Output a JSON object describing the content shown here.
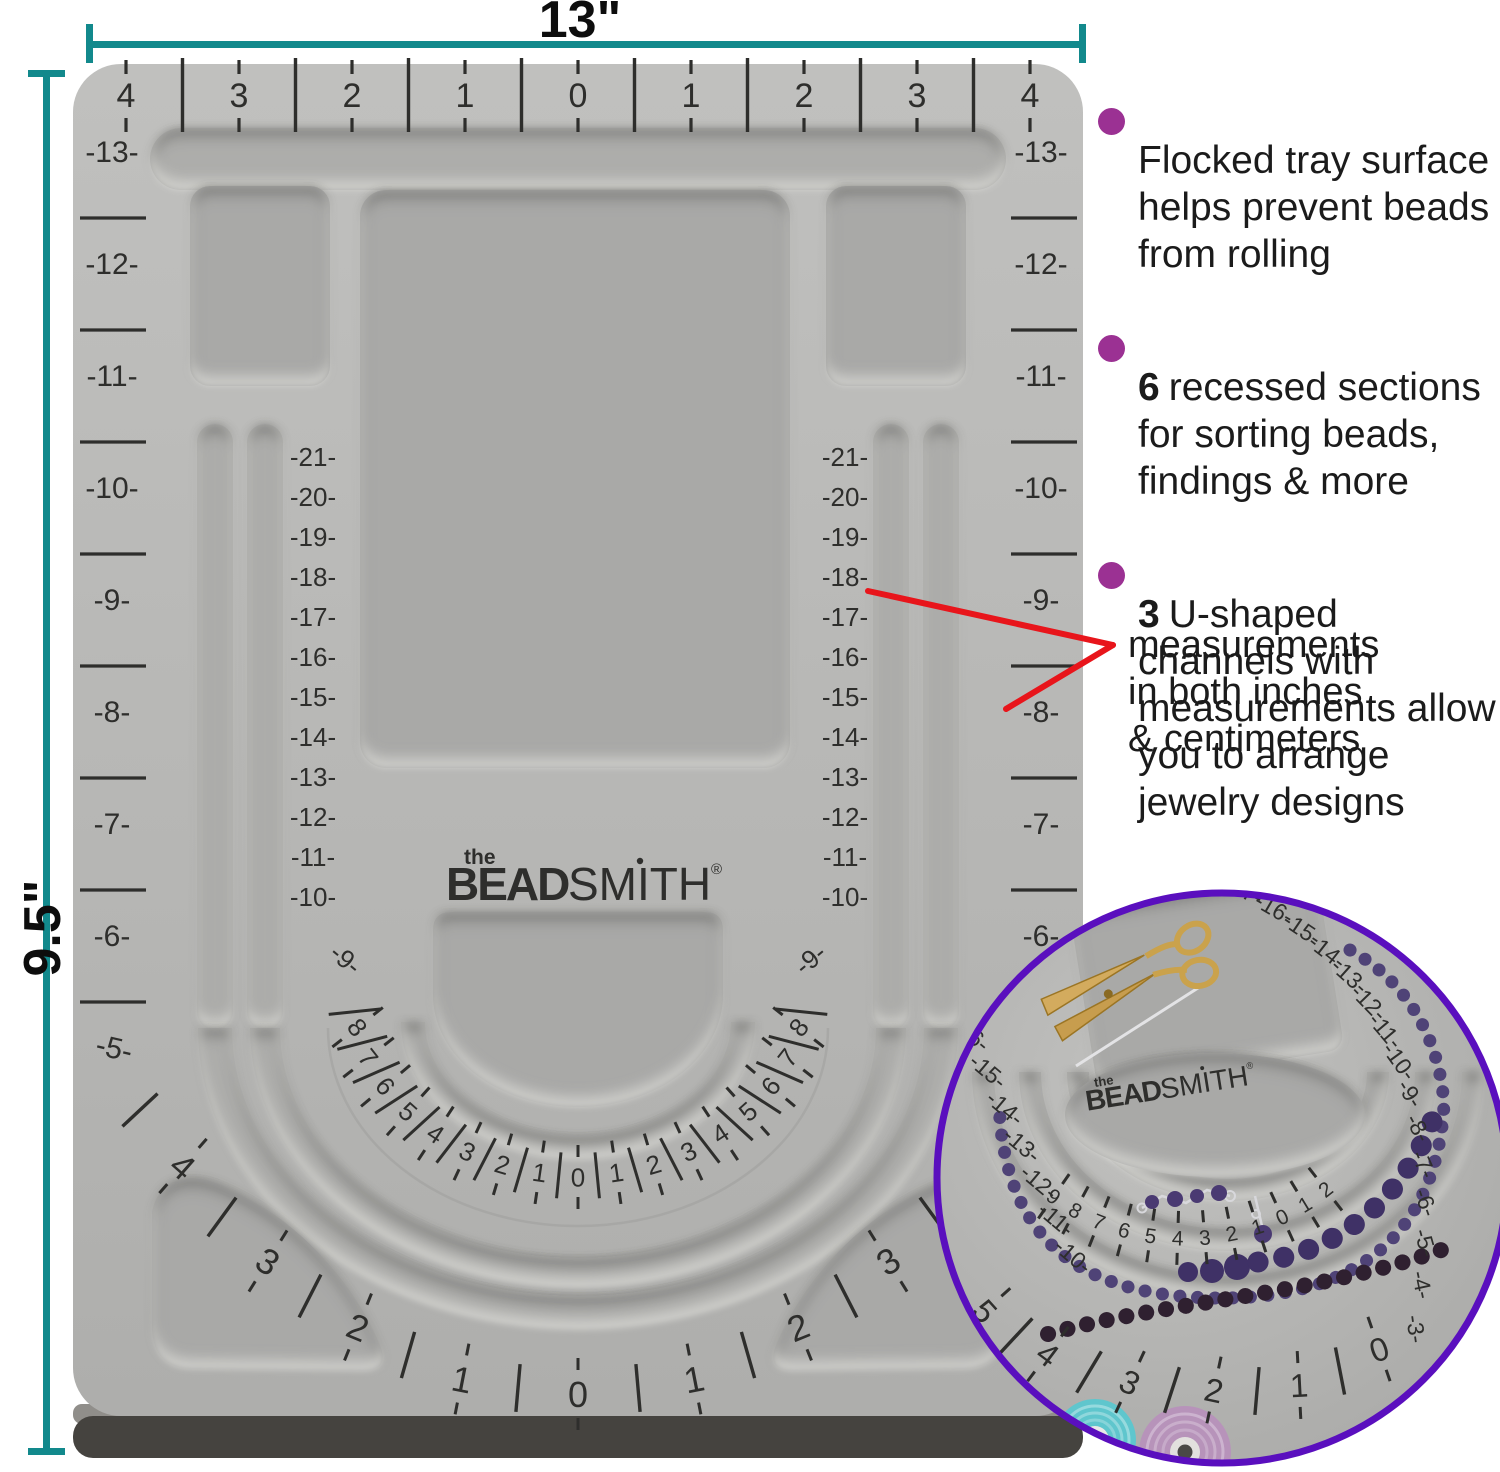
{
  "colors": {
    "teal": "#12898c",
    "red": "#e8151b",
    "bullet": "#9b3193",
    "ring": "#5a0fbe",
    "board": "#b8b8b6",
    "recess": "#a9a9a7",
    "groove": "#adadab",
    "ink": "#2e2e2c"
  },
  "dims": {
    "width": "13\"",
    "height": "9.5\""
  },
  "features": [
    {
      "num": "",
      "text": "Flocked tray surface helps prevent beads from rolling"
    },
    {
      "num": "6",
      "text": "recessed sections for sorting beads, findings & more"
    },
    {
      "num": "3",
      "text": "U-shaped channels with measurements allow you to arrange jewelry designs"
    }
  ],
  "callout": [
    "measurements",
    "in both inches",
    "& centimeters"
  ],
  "logo": {
    "the": "the",
    "bead": "BEAD",
    "smith": "SMITH",
    "reg": "®"
  },
  "board": {
    "top_scale": [
      "4",
      "3",
      "2",
      "1",
      "0",
      "1",
      "2",
      "3",
      "4"
    ],
    "rim_side": [
      "13",
      "12",
      "11",
      "10",
      "9",
      "8",
      "7",
      "6",
      "5"
    ],
    "rim_corner": [
      "4",
      "3",
      "2",
      "1"
    ],
    "rim_bottom_center": "0",
    "channel_column": [
      "21",
      "20",
      "19",
      "18",
      "17",
      "16",
      "15",
      "14",
      "13",
      "12",
      "11",
      "10"
    ],
    "channel_arc": [
      "9",
      "8",
      "7",
      "6",
      "5",
      "4",
      "3",
      "2",
      "1"
    ],
    "channel_arc_center": "0"
  },
  "inset": {
    "left_column": [
      "16",
      "15",
      "14",
      "13",
      "12",
      "11",
      "10"
    ],
    "right_arc": [
      "17",
      "16",
      "15",
      "14",
      "13",
      "12",
      "11",
      "10",
      "9",
      "8",
      "7",
      "6",
      "5",
      "4",
      "3"
    ],
    "mid_arc": [
      "9",
      "8",
      "7",
      "6",
      "5",
      "4",
      "3",
      "2",
      "1",
      "0",
      "1",
      "2"
    ],
    "outer_arc": [
      "5",
      "4",
      "3",
      "2",
      "1",
      "0"
    ]
  }
}
